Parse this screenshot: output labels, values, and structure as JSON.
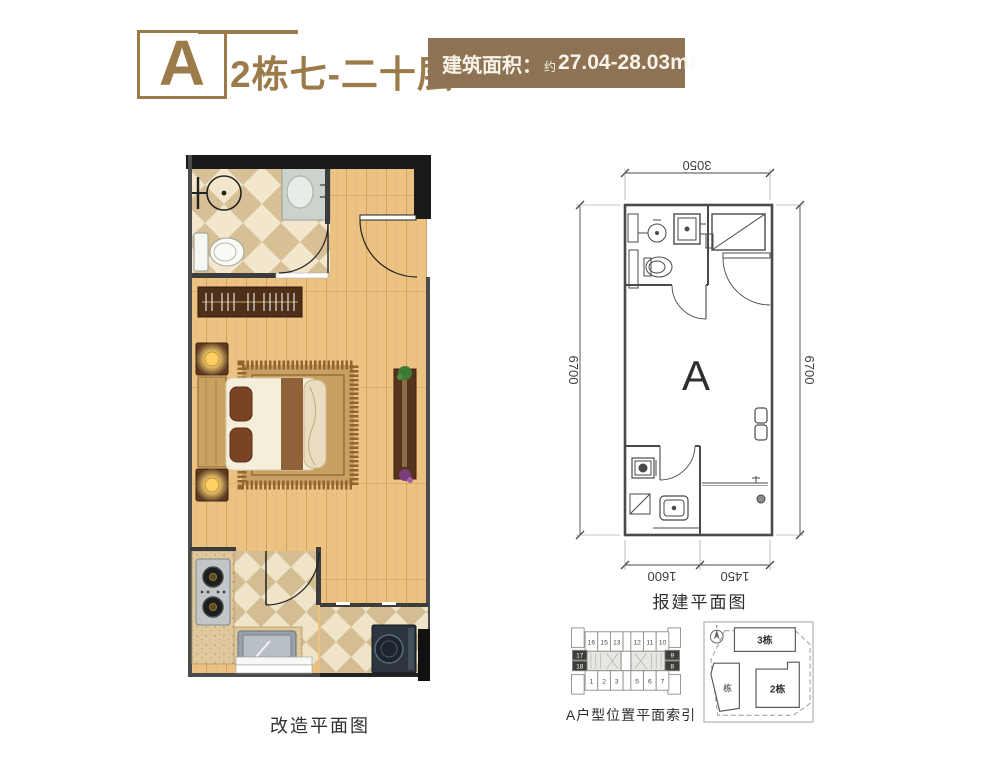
{
  "header": {
    "logo_letter": "A",
    "building_floor": "2栋七-二十层",
    "area_label": "建筑面积：",
    "area_prefix": "约",
    "area_value": "27.04-28.03m",
    "area_superscript": "2"
  },
  "colors": {
    "accent": "#9b7b4a",
    "area_box_bg": "#8d7353"
  },
  "renovation_plan": {
    "caption": "改造平面图"
  },
  "approval_plan": {
    "caption": "报建平面图",
    "room_label": "A",
    "dim_top": "3050",
    "dim_left": "6700",
    "dim_right": "6700",
    "dim_bottom_left": "1600",
    "dim_bottom_right": "1450"
  },
  "location_index": {
    "caption": "A户型位置平面索引",
    "top_row": [
      "16",
      "15",
      "13",
      "12",
      "11",
      "10"
    ],
    "left_units": [
      "17",
      "18"
    ],
    "right_units": [
      "9",
      "8"
    ],
    "bottom_row": [
      "1",
      "2",
      "3",
      "5",
      "6",
      "7"
    ]
  },
  "site_plan": {
    "building_3": "3栋",
    "building_1": "栋",
    "building_2": "2栋"
  }
}
